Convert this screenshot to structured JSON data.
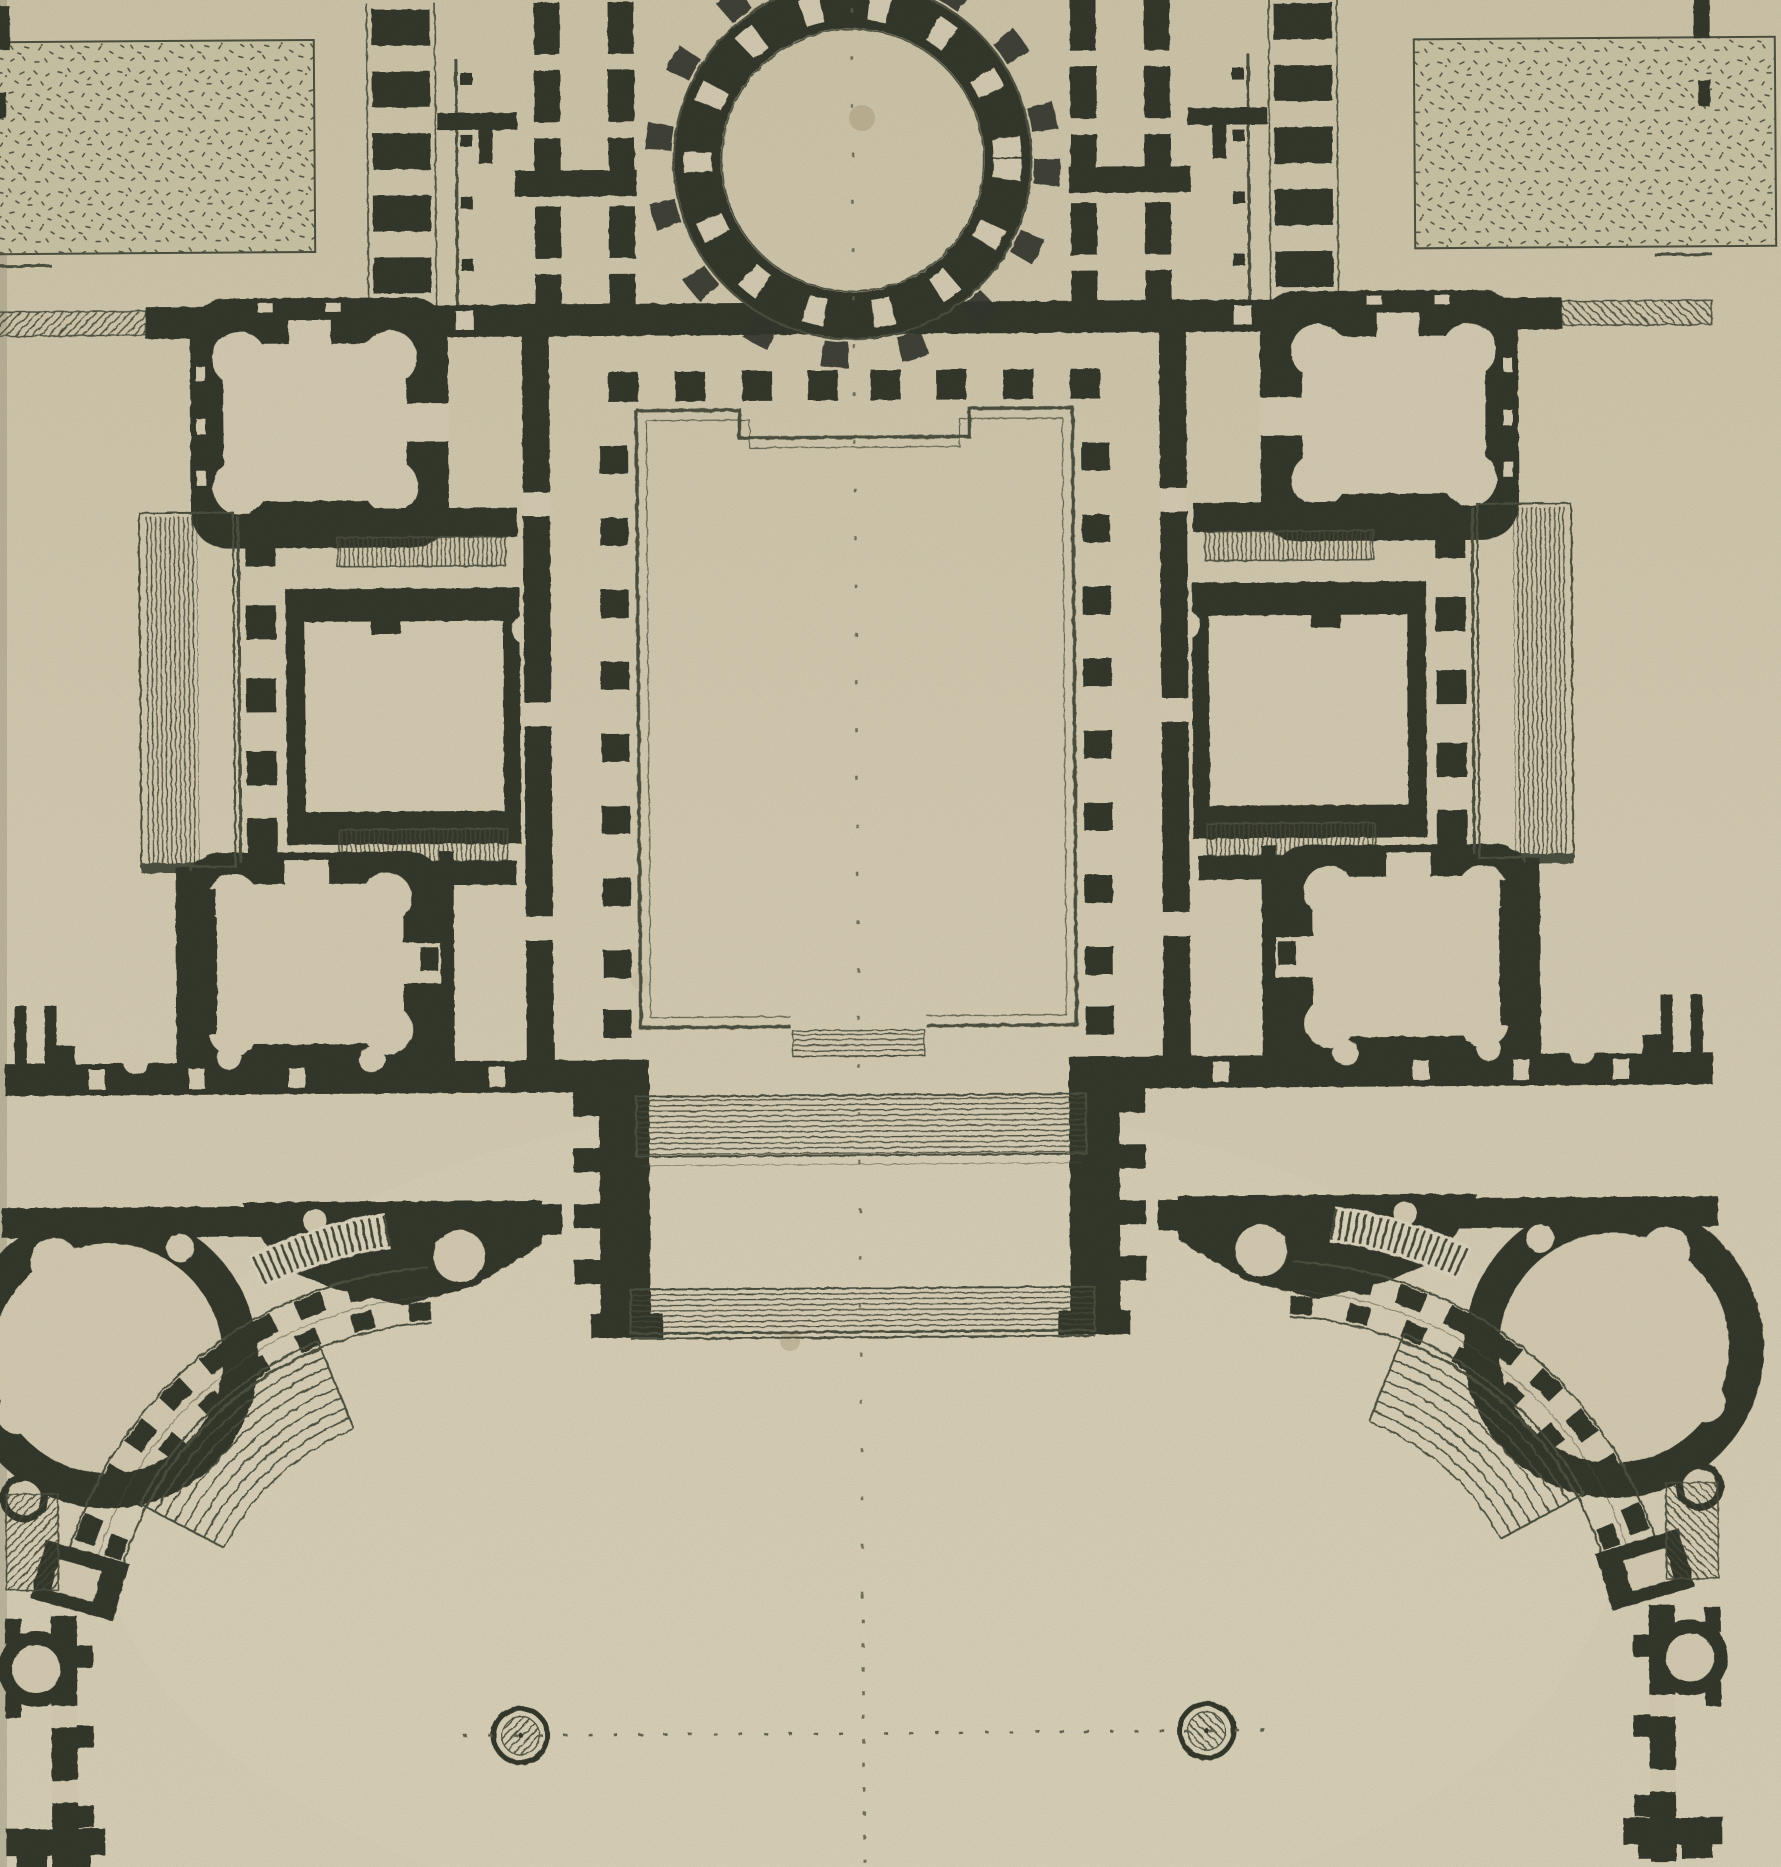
{
  "figure": {
    "kind": "architectural-floor-plan-etching",
    "title": "Neoclassical palace plan: rotunda, great hall, symmetric wings and curved colonnade forecourt",
    "medium": "ink engraving on aged paper"
  },
  "palette": {
    "paper": "#d5ccb2",
    "paper_light": "#ded6bf",
    "paper_dark": "#ccc3a6",
    "ink": "#2e3126",
    "ink_soft": "#3d4134",
    "line": "#474b3a",
    "hatch": "#3f4233",
    "stipple_bg": "#cbc5a6",
    "stipple_dot": "#4a4d3d",
    "dash": "#5c5c49",
    "stain": "#ab9c7c",
    "edge": "#6b6a55"
  },
  "plan": {
    "axis_x": 858,
    "features": {
      "garden_parterre_west": {
        "label": "Stippled garden parterre, north-west"
      },
      "garden_parterre_east": {
        "label": "Stippled garden parterre, north-east"
      },
      "rotunda": {
        "label": "Circular rotunda with ring of columns and niches"
      },
      "central_hall": {
        "label": "Great rectangular hall on the main axis"
      },
      "hall_door_steps": {
        "label": "Steps at south door of great hall"
      },
      "west_wing": {
        "label": "West apartment wing"
      },
      "east_wing": {
        "label": "East apartment wing (mirror of west)"
      },
      "quatrefoil_salon_upper": {
        "label": "Quatrefoil salon with round corner cabinets, north"
      },
      "quatrefoil_salon_lower": {
        "label": "Quatrefoil salon with round corner cabinets, south"
      },
      "oblong_salon": {
        "label": "Oblong central salon of the wing"
      },
      "side_portico": {
        "label": "Lateral portico with hatched steps"
      },
      "stair_upper": {
        "label": "Upper stair flight of the wing"
      },
      "stair_lower": {
        "label": "Lower stair flight of the wing"
      },
      "south_gallery": {
        "label": "South gallery linking wing to forecourt"
      },
      "curved_colonnade": {
        "label": "Curved colonnade of the cour d'honneur"
      },
      "amphitheatre_steps": {
        "label": "Fan of curved steps to the forecourt"
      },
      "round_pavilion": {
        "label": "Round corner pavilion with circular cabinets"
      },
      "corner_pier": {
        "label": "Pier at end of curved colonnade"
      },
      "terrace_steps_upper": {
        "label": "Upper terrace steps on axis"
      },
      "terrace_steps_lower": {
        "label": "Lower terrace steps on axis"
      },
      "fountain_west": {
        "label": "West fountain basin"
      },
      "fountain_east": {
        "label": "East fountain basin"
      },
      "main_axis": {
        "label": "Dashed main axis line"
      },
      "cross_axis": {
        "label": "Dashed cross axis through fountains"
      }
    }
  }
}
